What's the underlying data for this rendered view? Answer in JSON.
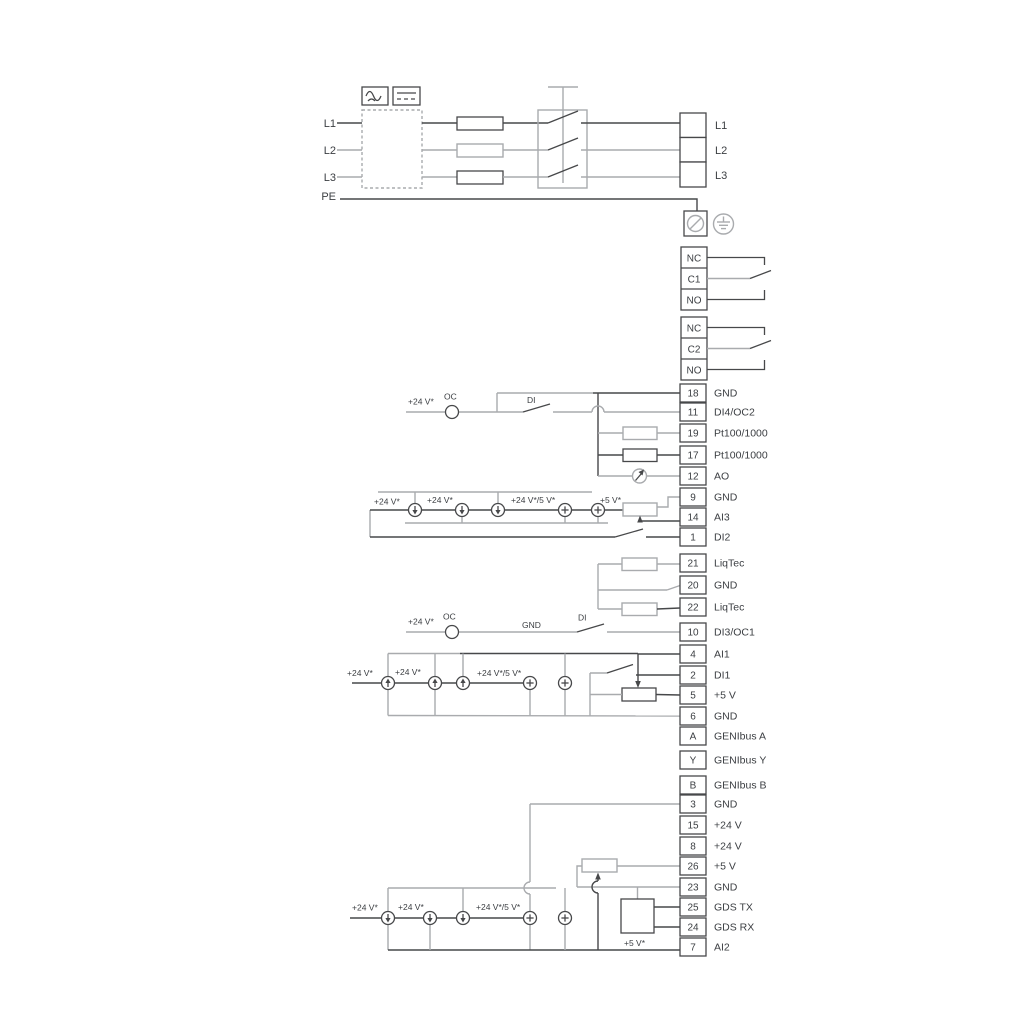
{
  "colors": {
    "line_dark": "#47484a",
    "line_gray": "#a9abae",
    "text": "#3b3e42",
    "background": "#ffffff"
  },
  "power_input": {
    "l1": "L1",
    "l2": "L2",
    "l3": "L3",
    "pe": "PE"
  },
  "motor_output": {
    "l1": "L1",
    "l2": "L2",
    "l3": "L3"
  },
  "relay1": {
    "nc": "NC",
    "c": "C1",
    "no": "NO"
  },
  "relay2": {
    "nc": "NC",
    "c": "C2",
    "no": "NO"
  },
  "labels": {
    "v24": "+24 V*",
    "v24_or_5": "+24 V*/5 V*",
    "v5": "+5 V*",
    "oc": "OC",
    "di": "DI",
    "gnd": "GND"
  },
  "terminals": [
    {
      "num": "18",
      "label": "GND"
    },
    {
      "num": "11",
      "label": "DI4/OC2"
    },
    {
      "num": "19",
      "label": "Pt100/1000"
    },
    {
      "num": "17",
      "label": "Pt100/1000"
    },
    {
      "num": "12",
      "label": "AO"
    },
    {
      "num": "9",
      "label": "GND"
    },
    {
      "num": "14",
      "label": "AI3"
    },
    {
      "num": "1",
      "label": "DI2"
    },
    {
      "num": "21",
      "label": "LiqTec"
    },
    {
      "num": "20",
      "label": "GND"
    },
    {
      "num": "22",
      "label": "LiqTec"
    },
    {
      "num": "10",
      "label": "DI3/OC1"
    },
    {
      "num": "4",
      "label": "AI1"
    },
    {
      "num": "2",
      "label": "DI1"
    },
    {
      "num": "5",
      "label": "+5 V"
    },
    {
      "num": "6",
      "label": "GND"
    },
    {
      "num": "A",
      "label": "GENIbus A"
    },
    {
      "num": "Y",
      "label": "GENIbus Y"
    },
    {
      "num": "B",
      "label": "GENIbus B"
    },
    {
      "num": "3",
      "label": "GND"
    },
    {
      "num": "15",
      "label": "+24 V"
    },
    {
      "num": "8",
      "label": "+24 V"
    },
    {
      "num": "26",
      "label": "+5 V"
    },
    {
      "num": "23",
      "label": "GND"
    },
    {
      "num": "25",
      "label": "GDS TX"
    },
    {
      "num": "24",
      "label": "GDS RX"
    },
    {
      "num": "7",
      "label": "AI2"
    }
  ]
}
